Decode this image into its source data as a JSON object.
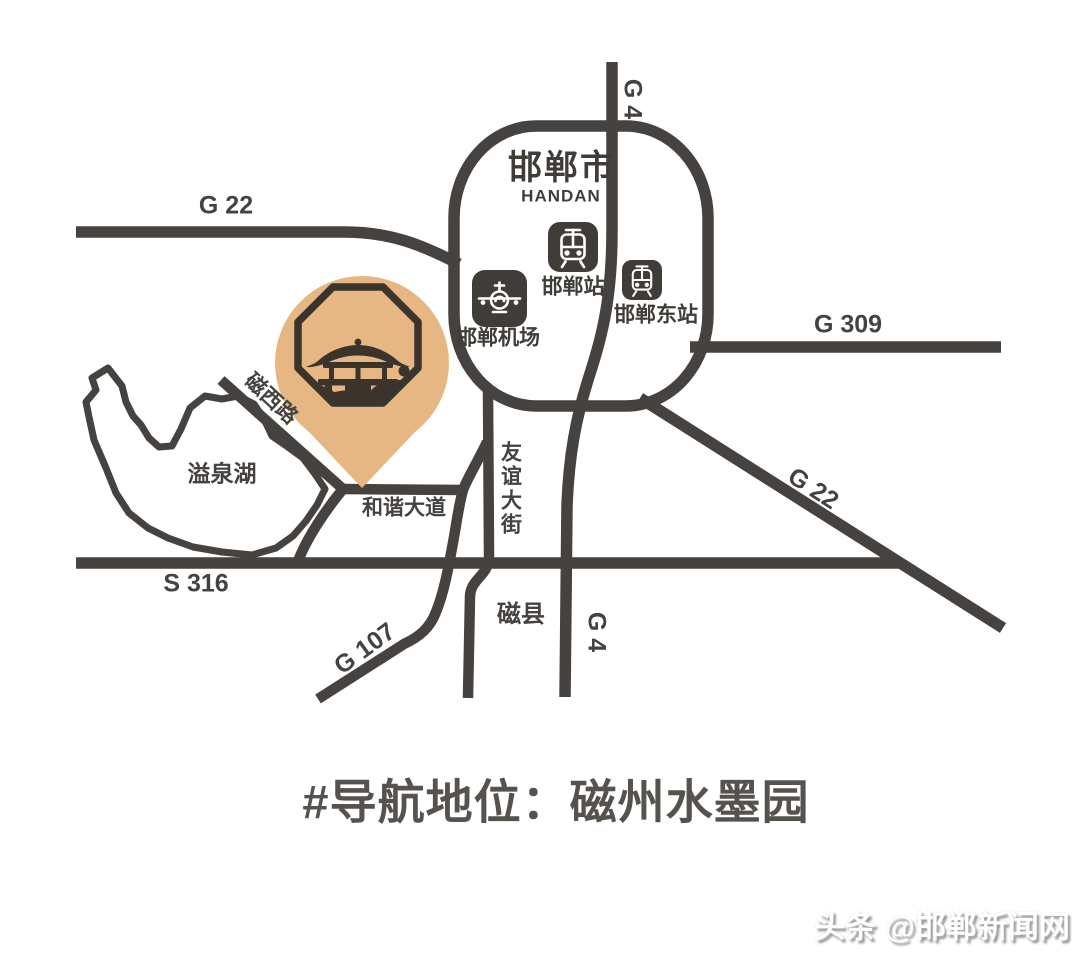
{
  "map": {
    "city": {
      "name": "邯郸市",
      "name_en": "HANDAN"
    },
    "roads": {
      "g22_nw": {
        "label": "G 22"
      },
      "g4_top": {
        "label": "G 4"
      },
      "g4_bottom": {
        "label": "G 4"
      },
      "g309": {
        "label": "G 309"
      },
      "g22_se": {
        "label": "G 22"
      },
      "s316": {
        "label": "S 316"
      },
      "g107": {
        "label": "G 107"
      },
      "cixi": {
        "label": "磁西路"
      },
      "hexie": {
        "label": "和谐大道"
      },
      "youyi": {
        "label": "友谊大街"
      }
    },
    "stations": {
      "handan_station": {
        "label": "邯郸站",
        "icon": "train-station-icon"
      },
      "handan_east": {
        "label": "邯郸东站",
        "icon": "train-station-icon"
      },
      "airport": {
        "label": "邯郸机场",
        "icon": "airport-icon"
      }
    },
    "lake": {
      "label": "溢泉湖"
    },
    "county": {
      "label": "磁县"
    },
    "destination_pin": {
      "place": "磁州水墨园",
      "icon": "pavilion-pin-icon"
    }
  },
  "caption": {
    "text": "#导航地位：磁州水墨园"
  },
  "watermark": {
    "text": "头条 @邯郸新闻网"
  },
  "colors": {
    "road": "#454240",
    "pin_fill": "#e7b783",
    "pin_ink": "#3a342c",
    "icon_bg": "#403c38",
    "label_text": "#454240",
    "caption_text": "#56534f",
    "background": "#ffffff"
  }
}
